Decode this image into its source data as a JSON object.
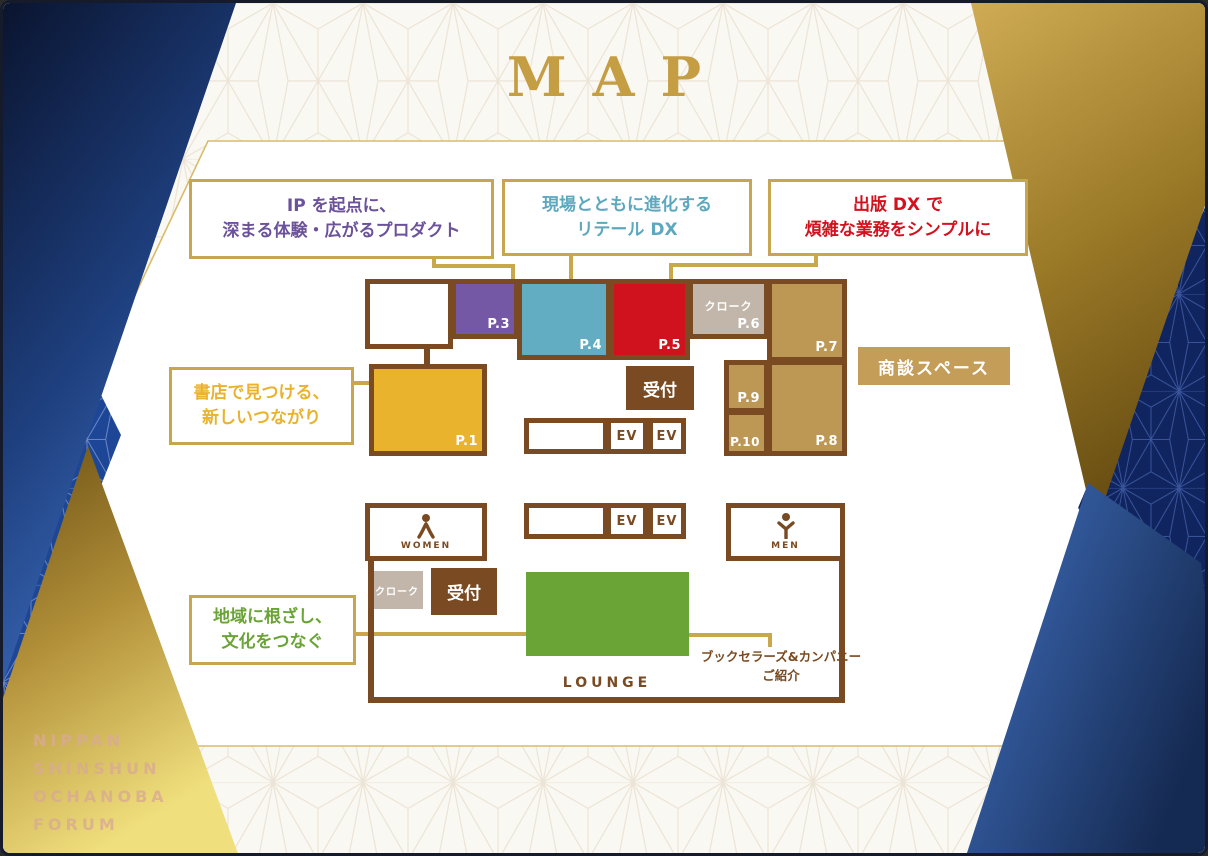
{
  "title": "MAP",
  "branding": {
    "line1": "NIPPAN",
    "line2": "SHINSHUN",
    "line3": "OCHANOBA",
    "line4": "FORUM"
  },
  "callouts": {
    "ip": {
      "line1": "IP を起点に、",
      "line2": "深まる体験・広がるプロダクト",
      "color": "#6c529b"
    },
    "retail": {
      "line1": "現場とともに進化する",
      "line2": "リテール DX",
      "color": "#5ea8bf"
    },
    "dx": {
      "line1": "出版 DX で",
      "line2": "煩雑な業務をシンプルに",
      "color": "#d3121f"
    },
    "bookstore": {
      "line1": "書店で見つける、",
      "line2": "新しいつながり",
      "color": "#e9b32e"
    },
    "region": {
      "line1": "地域に根ざし、",
      "line2": "文化をつなぐ",
      "color": "#6ba436"
    },
    "booksellers": {
      "line1": "ブックセラーズ&カンパニー",
      "line2": "ご紹介",
      "color": "#7a4b22"
    }
  },
  "plan": {
    "booths": {
      "p1": {
        "label": "P.1",
        "color": "#e9b32e"
      },
      "p3": {
        "label": "P.3",
        "color": "#7458a5"
      },
      "p4": {
        "label": "P.4",
        "color": "#63adc2"
      },
      "p5": {
        "label": "P.5",
        "color": "#d0121f"
      },
      "p6": {
        "label": "P.6",
        "color": "#c2b6aa"
      },
      "p7": {
        "label": "P.7",
        "color": "#bd9855"
      },
      "p8": {
        "label": "P.8",
        "color": "#bd9855"
      },
      "p9": {
        "label": "P.9",
        "color": "#bd9855"
      },
      "p10": {
        "label": "P.10",
        "color": "#bd9855"
      }
    },
    "cloak_label": "クローク",
    "reception_label": "受付",
    "ev_label": "EV",
    "women_label": "WOMEN",
    "men_label": "MEN",
    "meeting_space_label": "商談スペース",
    "lounge_label": "LOUNGE"
  },
  "colors": {
    "wall_brown": "#7a4b22",
    "connector_gold": "#c9a84c",
    "title_gold": "#c59d43",
    "navy_wedge": "#0c1836",
    "blue_wedge": "#4272c2",
    "cream_bg": "#faf8f2",
    "meeting_space_fill": "#c49e59",
    "lounge_green": "#6ba436"
  }
}
